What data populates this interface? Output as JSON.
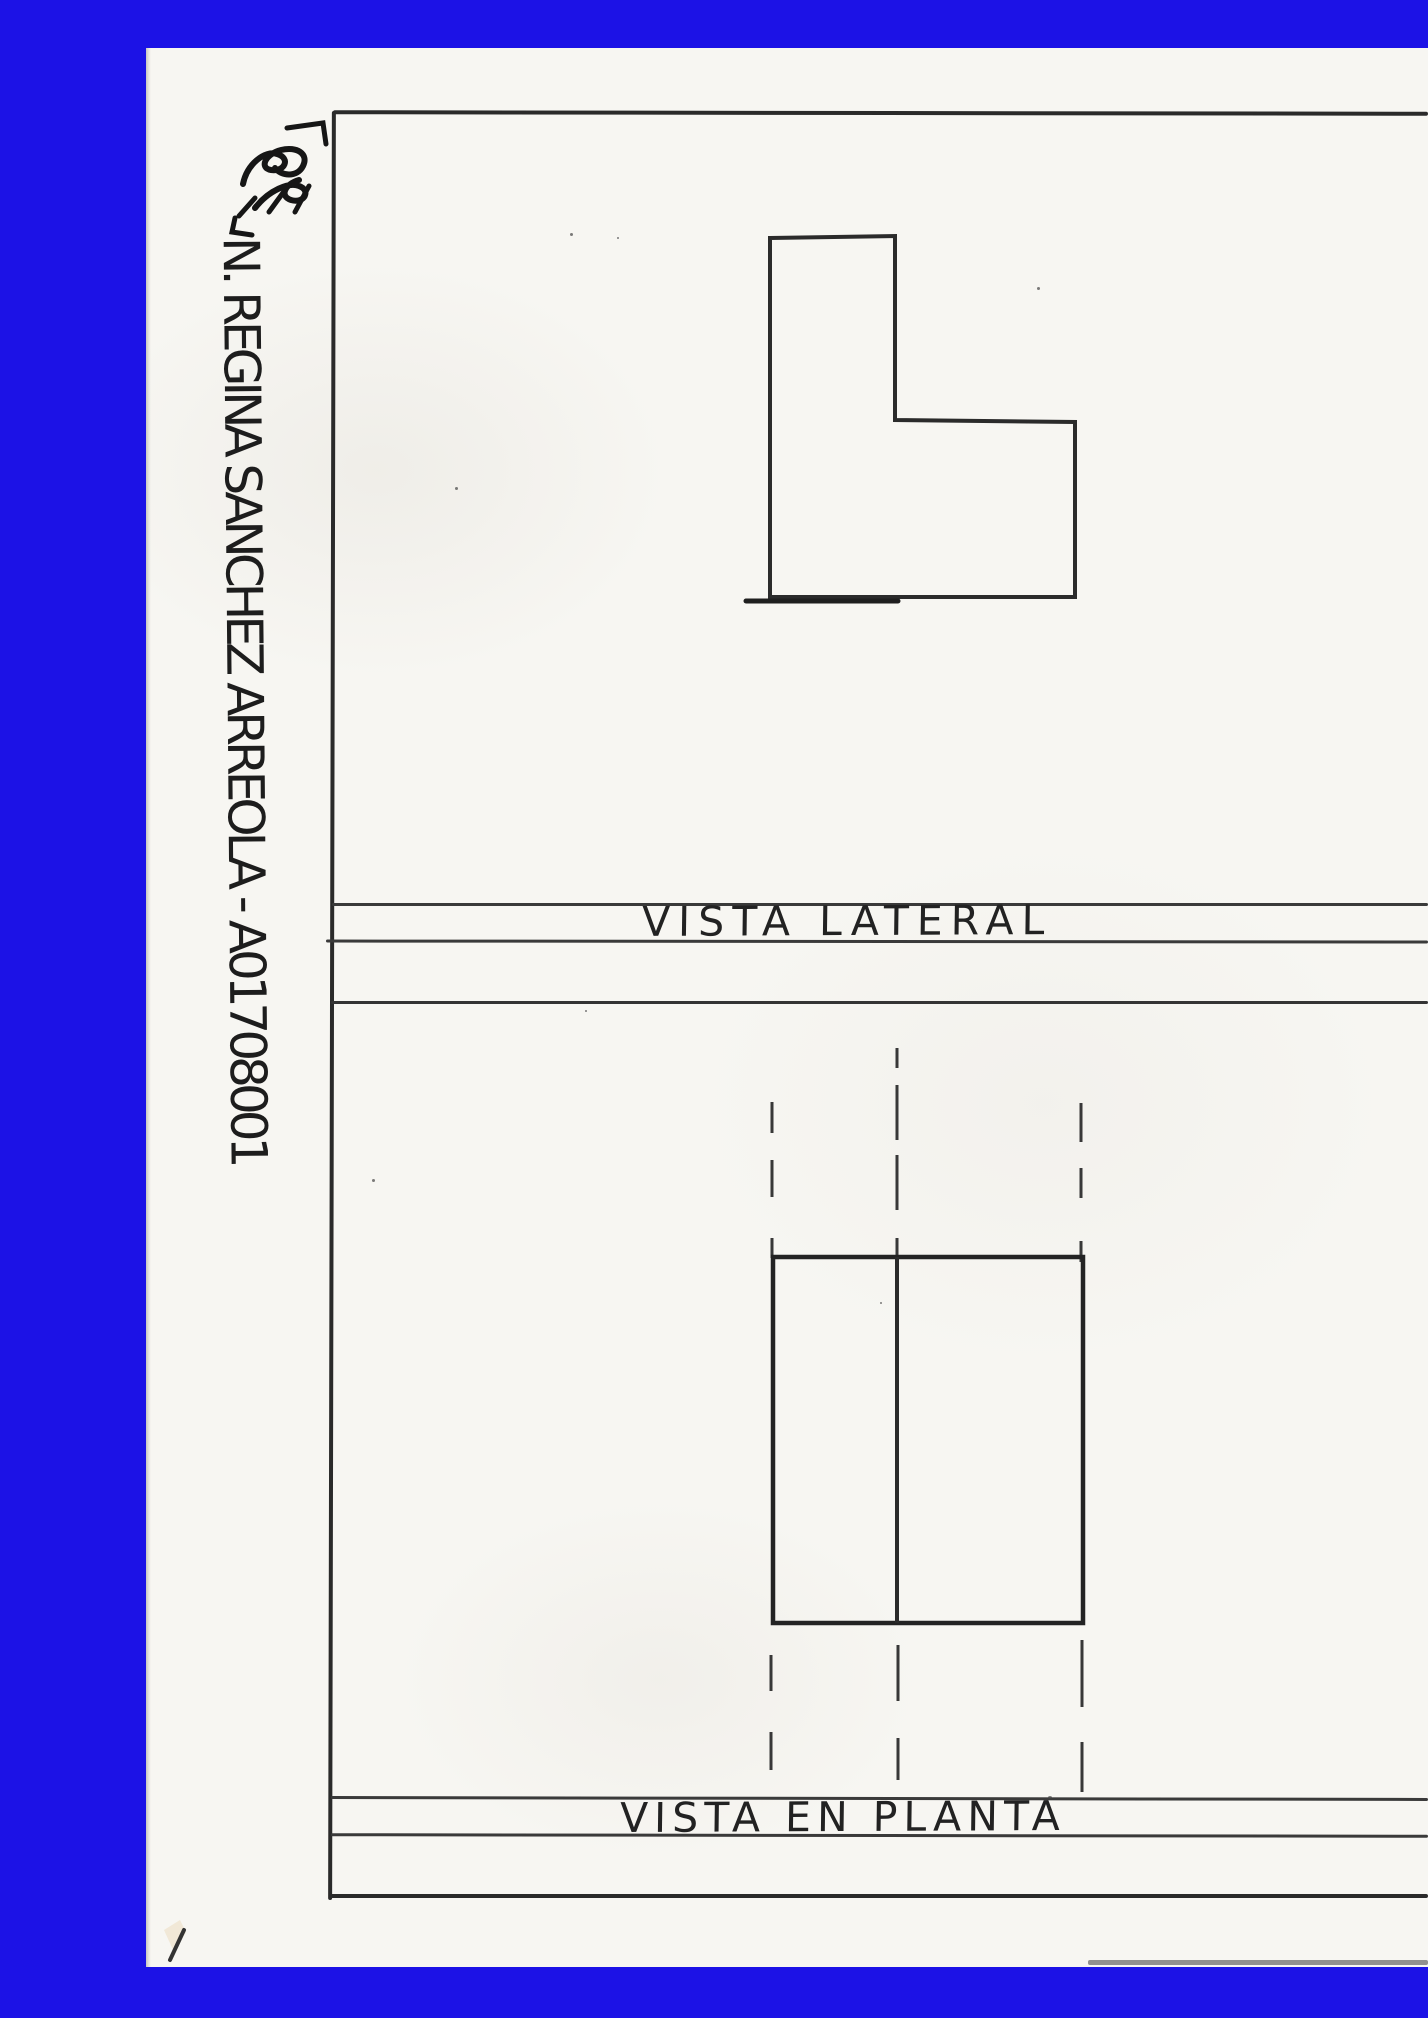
{
  "margin": {
    "student_name": "N. REGINA SANCHEZ ARREOLA - A01708001"
  },
  "views": {
    "lateral": {
      "label": "VISTA LATERAL"
    },
    "plan": {
      "label": "VISTA EN PLANTA"
    }
  },
  "colors": {
    "border_blue": "#1c12e6",
    "paper": "#f7f6f2",
    "ink": "#2a2a2a"
  }
}
